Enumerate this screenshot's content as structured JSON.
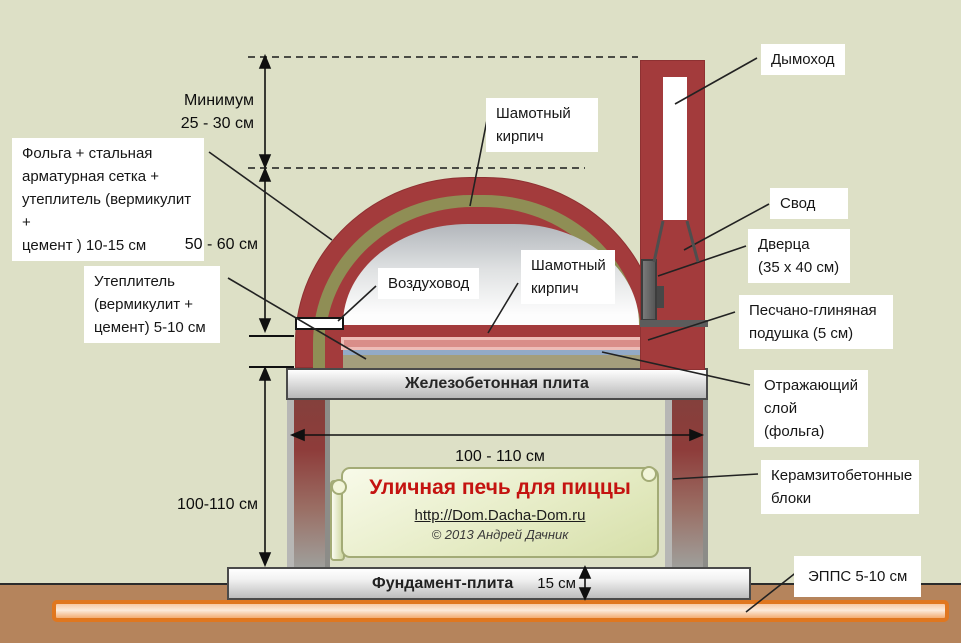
{
  "diagram": {
    "title": "Уличная печь для пиццы",
    "url": "http://Dom.Dacha-Dom.ru",
    "copyright": "© 2013 Андрей Дачник"
  },
  "labels": {
    "foil": [
      "Фольга + стальная",
      "арматурная сетка  +",
      "утеплитель (вермикулит +",
      "цемент ) 10-15  см"
    ],
    "insulation": [
      "Утеплитель",
      "(вермикулит +",
      "цемент) 5-10  см"
    ],
    "firebrick_dome": [
      "Шамотный",
      "кирпич"
    ],
    "air_duct": "Воздуховод",
    "firebrick_hearth": [
      "Шамотный",
      "кирпич"
    ],
    "chimney": "Дымоход",
    "vault": "Свод",
    "door": [
      "Дверца",
      "(35 x 40  см)"
    ],
    "sand_clay_cushion": [
      "Песчано-глиняная",
      "подушка  (5 см)"
    ],
    "reflective_layer": [
      "Отражающий",
      "слой (фольга)"
    ],
    "blocks": [
      "Керамзитобетонные",
      "блоки"
    ],
    "epps": "ЭППС 5-10  см"
  },
  "dimensions": {
    "min_clearance_label": "Минимум",
    "min_clearance_value": "25 - 30 см",
    "dome_height": "50 - 60 см",
    "stand_height": "100-110 см",
    "stand_width": "100 - 110 см",
    "foundation_thickness": "15 см"
  },
  "slabs": {
    "reinforced_concrete": "Железобетонная плита",
    "foundation": "Фундамент-плита"
  },
  "colors": {
    "background": "#dde0c6",
    "brick_red": "#a33b3c",
    "insulation_olive": "#8f8e55",
    "cushion_pink": "#d98e89",
    "foil_blue": "#93aac7",
    "epps_orange": "#e0771f",
    "ground_brown": "#b5845c",
    "title_red": "#c41310"
  }
}
